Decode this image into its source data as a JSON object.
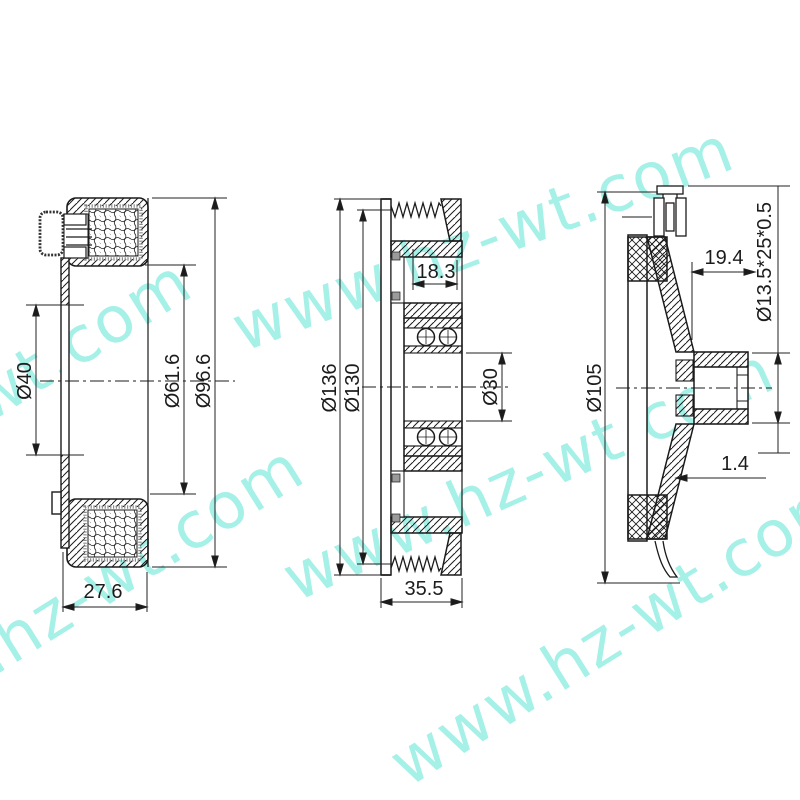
{
  "drawing_title": "compressor clutch assembly drawing",
  "watermark": {
    "text": "www.hz-wt.com",
    "color": "#6fe7d9"
  },
  "line_color": "#1b1b1b",
  "views": {
    "coil": {
      "name": "field coil side section",
      "dims": {
        "bore": "Ø40",
        "inner_dia": "Ø61.6",
        "outer_dia": "Ø96.6",
        "depth": "27.6"
      }
    },
    "pulley": {
      "name": "pulley cross section",
      "dims": {
        "outer_dia": "Ø136",
        "groove_dia": "Ø130",
        "hub_width": "18.3",
        "bore": "Ø30",
        "total_width": "35.5"
      }
    },
    "hub": {
      "name": "clutch hub cross section",
      "dims": {
        "outer_dia": "Ø105",
        "protrusion": "19.4",
        "shaft_spec": "Ø13.5*25*0.5",
        "plate_thickness": "1.4"
      }
    }
  }
}
